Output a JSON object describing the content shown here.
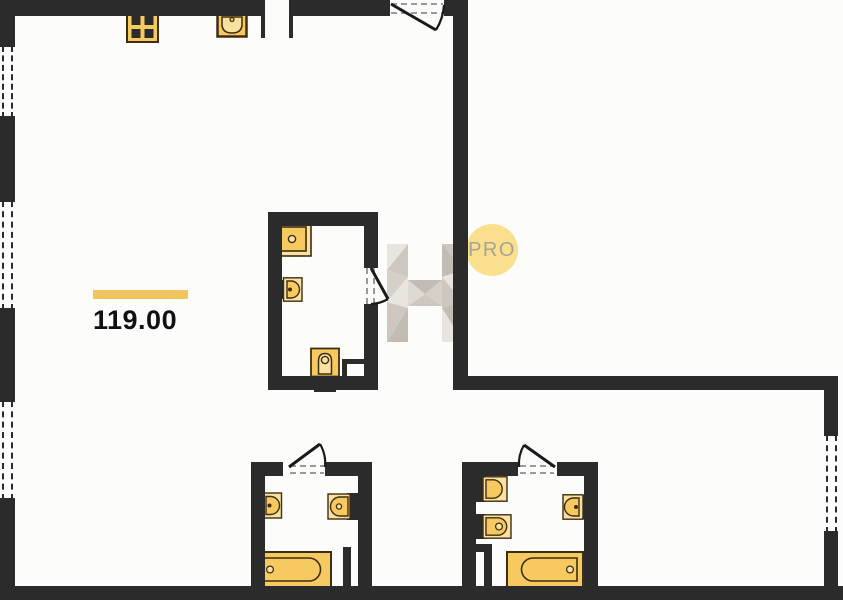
{
  "plan": {
    "area_value": "119.00",
    "badge_label": "PRO",
    "watermark_letter": "H"
  },
  "colors": {
    "wall": "#2B2B2B",
    "background": "#FCFCFB",
    "fixture_fill": "#F7CA61",
    "fixture_rim": "#F9E2A1",
    "fixture_outline": "#3F2D10",
    "burner": "#2B2B2B",
    "area_bar": "#F2C45E",
    "area_text": "#111111",
    "badge_bg": "#FAE08D",
    "badge_text": "#A5A395",
    "door_dash": "#9A9A9A",
    "door_line": "#1A1A1A",
    "watermark_facets": [
      "#DCD8D1",
      "#CBC5BC",
      "#E7E4DF",
      "#BFB9AF",
      "#D3CEC6"
    ]
  },
  "counts": {
    "windows": 4,
    "doors": 4
  },
  "fixtures": [
    {
      "name": "stove-icon",
      "location": "kitchen-top-wall"
    },
    {
      "name": "kitchen-sink-icon",
      "location": "kitchen-top-wall"
    },
    {
      "name": "shower-tray-icon",
      "location": "center-bathroom"
    },
    {
      "name": "washbasin-icon",
      "location": "center-bathroom"
    },
    {
      "name": "toilet-icon",
      "location": "center-bathroom"
    },
    {
      "name": "washbasin-icon",
      "location": "bottom-left-bathroom"
    },
    {
      "name": "toilet-icon",
      "location": "bottom-left-bathroom"
    },
    {
      "name": "bathtub-icon",
      "location": "bottom-left-bathroom"
    },
    {
      "name": "toilet-icon",
      "location": "bottom-right-bathroom"
    },
    {
      "name": "bidet-icon",
      "location": "bottom-right-bathroom"
    },
    {
      "name": "washbasin-icon",
      "location": "bottom-right-bathroom"
    },
    {
      "name": "bathtub-icon",
      "location": "bottom-right-bathroom"
    }
  ]
}
